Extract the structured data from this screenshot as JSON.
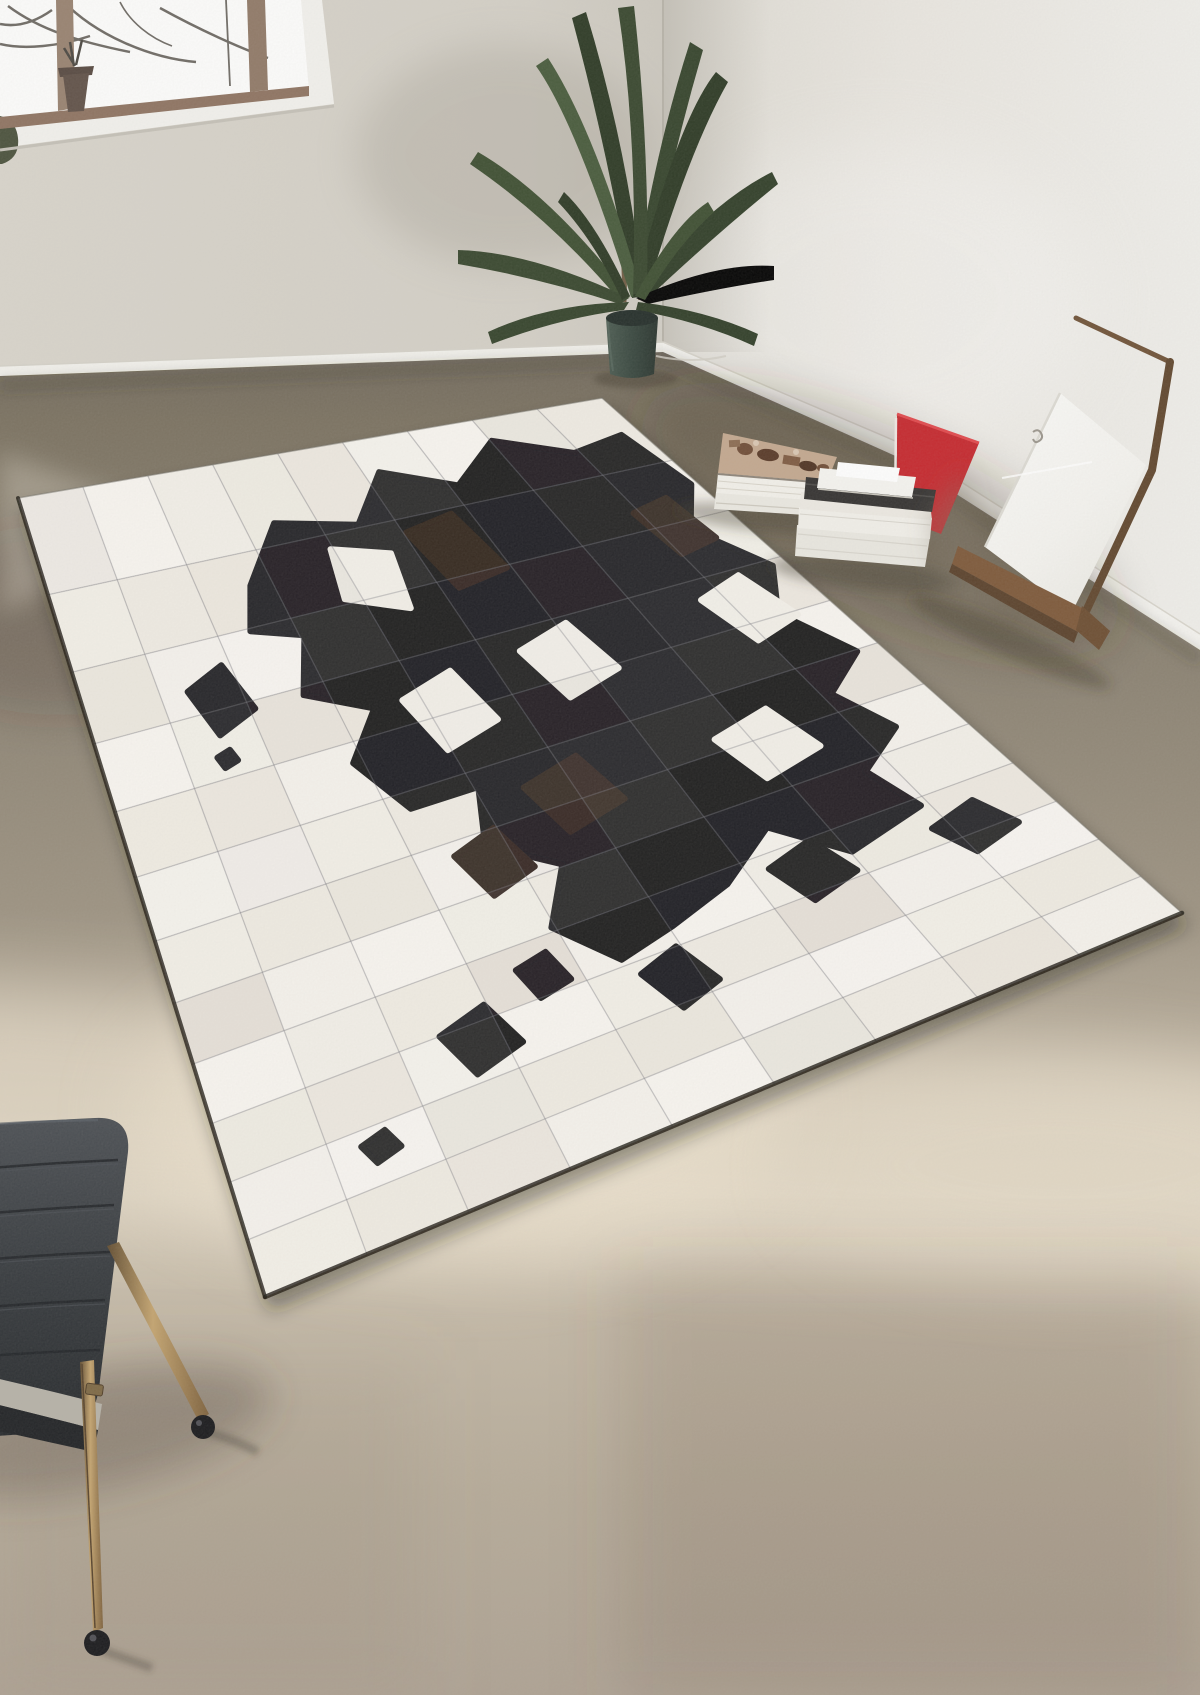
{
  "scene": {
    "kind": "interior-photo",
    "objects": [
      "window-with-branches",
      "palm-plant",
      "planter-pot",
      "wall-corner",
      "baseboard",
      "book-stack-left",
      "book-stack-right",
      "red-folder",
      "leaning-canvas",
      "wooden-easel",
      "patchwork-cowhide-rug",
      "side-chair",
      "sunlit-floor-patch"
    ]
  },
  "palette": {
    "wall_left": "#d6d2c9",
    "wall_right": "#e9e6e0",
    "baseboard": "#f3f2ee",
    "floor_dark": "#6e665a",
    "floor_mid": "#9b9180",
    "floor_sunlit": "#e0d6c4",
    "floor_bottom": "#ada192",
    "rug_white": "#f2efe8",
    "rug_black": "#17171a",
    "rug_brown": "#2e211b",
    "rug_seam": "#7d7d87",
    "plant_green": "#33422a",
    "pot_teal": "#3b4a42",
    "wood_brown": "#7c5738",
    "red_board": "#c5262c",
    "canvas_white": "#f7f6f3",
    "chair_back": "#34373b",
    "chair_brass": "#9a7b4f",
    "foot_black": "#1a1a1d"
  },
  "rug": {
    "cols": 9,
    "rows": 12,
    "perspective_pow": 0.85,
    "corners": {
      "w": [
        18,
        498
      ],
      "n": [
        602,
        398
      ],
      "e": [
        1182,
        913
      ],
      "s": [
        265,
        1297
      ]
    },
    "white_tiles": [
      "#f5f2ec",
      "#efebe2",
      "#f8f5f0",
      "#ece7de",
      "#f2efe7"
    ],
    "blobs": [
      {
        "name": "main-cow-patch",
        "fill": "black",
        "uv": [
          [
            0.3,
            0.12
          ],
          [
            0.38,
            0.06
          ],
          [
            0.5,
            0.08
          ],
          [
            0.58,
            0.03
          ],
          [
            0.68,
            0.06
          ],
          [
            0.78,
            0.02
          ],
          [
            0.88,
            0.05
          ],
          [
            0.97,
            0.04
          ],
          [
            0.99,
            0.12
          ],
          [
            0.93,
            0.18
          ],
          [
            0.98,
            0.26
          ],
          [
            0.93,
            0.33
          ],
          [
            0.97,
            0.42
          ],
          [
            0.9,
            0.47
          ],
          [
            0.93,
            0.55
          ],
          [
            0.86,
            0.6
          ],
          [
            0.88,
            0.68
          ],
          [
            0.78,
            0.71
          ],
          [
            0.72,
            0.63
          ],
          [
            0.64,
            0.69
          ],
          [
            0.56,
            0.72
          ],
          [
            0.49,
            0.74
          ],
          [
            0.44,
            0.66
          ],
          [
            0.49,
            0.58
          ],
          [
            0.42,
            0.52
          ],
          [
            0.45,
            0.44
          ],
          [
            0.36,
            0.44
          ],
          [
            0.32,
            0.36
          ],
          [
            0.38,
            0.3
          ],
          [
            0.3,
            0.26
          ],
          [
            0.34,
            0.19
          ],
          [
            0.27,
            0.17
          ]
        ]
      },
      {
        "name": "brown-shade-1",
        "fill": "brown",
        "uv": [
          [
            0.56,
            0.1
          ],
          [
            0.64,
            0.09
          ],
          [
            0.66,
            0.17
          ],
          [
            0.58,
            0.18
          ]
        ]
      },
      {
        "name": "brown-shade-2",
        "fill": "brown",
        "uv": [
          [
            0.5,
            0.46
          ],
          [
            0.58,
            0.44
          ],
          [
            0.6,
            0.52
          ],
          [
            0.52,
            0.54
          ]
        ]
      },
      {
        "name": "brown-shade-3",
        "fill": "brown",
        "uv": [
          [
            0.88,
            0.14
          ],
          [
            0.94,
            0.13
          ],
          [
            0.95,
            0.2
          ],
          [
            0.89,
            0.21
          ]
        ]
      },
      {
        "name": "brown-shade-4",
        "fill": "brown",
        "uv": [
          [
            0.38,
            0.52
          ],
          [
            0.44,
            0.5
          ],
          [
            0.46,
            0.57
          ],
          [
            0.4,
            0.59
          ]
        ]
      },
      {
        "name": "white-gap-1",
        "fill": "white",
        "uv": [
          [
            0.44,
            0.1
          ],
          [
            0.52,
            0.12
          ],
          [
            0.5,
            0.19
          ],
          [
            0.42,
            0.16
          ]
        ]
      },
      {
        "name": "white-gap-2",
        "fill": "white",
        "uv": [
          [
            0.42,
            0.3
          ],
          [
            0.5,
            0.28
          ],
          [
            0.52,
            0.36
          ],
          [
            0.44,
            0.38
          ]
        ]
      },
      {
        "name": "white-gap-3",
        "fill": "white",
        "uv": [
          [
            0.6,
            0.28
          ],
          [
            0.68,
            0.26
          ],
          [
            0.7,
            0.34
          ],
          [
            0.62,
            0.36
          ]
        ]
      },
      {
        "name": "white-gap-4",
        "fill": "white",
        "uv": [
          [
            0.86,
            0.28
          ],
          [
            0.93,
            0.26
          ],
          [
            0.95,
            0.34
          ],
          [
            0.88,
            0.36
          ]
        ]
      },
      {
        "name": "white-gap-5",
        "fill": "white",
        "uv": [
          [
            0.74,
            0.48
          ],
          [
            0.82,
            0.46
          ],
          [
            0.84,
            0.54
          ],
          [
            0.76,
            0.56
          ]
        ]
      },
      {
        "name": "spot-left",
        "fill": "black",
        "uv": [
          [
            0.15,
            0.22
          ],
          [
            0.21,
            0.2
          ],
          [
            0.23,
            0.26
          ],
          [
            0.17,
            0.28
          ]
        ]
      },
      {
        "name": "spot-left-speck",
        "fill": "black",
        "uv": [
          [
            0.155,
            0.305
          ],
          [
            0.175,
            0.3
          ],
          [
            0.18,
            0.315
          ],
          [
            0.16,
            0.32
          ]
        ]
      },
      {
        "name": "spot-right-1",
        "fill": "black",
        "uv": [
          [
            0.87,
            0.72
          ],
          [
            0.93,
            0.7
          ],
          [
            0.95,
            0.76
          ],
          [
            0.89,
            0.78
          ]
        ]
      },
      {
        "name": "spot-right-2",
        "fill": "black",
        "uv": [
          [
            0.69,
            0.69
          ],
          [
            0.75,
            0.67
          ],
          [
            0.77,
            0.74
          ],
          [
            0.71,
            0.76
          ]
        ]
      },
      {
        "name": "spot-bottom-1",
        "fill": "black",
        "uv": [
          [
            0.27,
            0.75
          ],
          [
            0.33,
            0.73
          ],
          [
            0.35,
            0.8
          ],
          [
            0.29,
            0.82
          ]
        ]
      },
      {
        "name": "spot-bottom-2",
        "fill": "black",
        "uv": [
          [
            0.38,
            0.7
          ],
          [
            0.42,
            0.69
          ],
          [
            0.43,
            0.74
          ],
          [
            0.39,
            0.75
          ]
        ]
      },
      {
        "name": "spot-bottom-3",
        "fill": "black",
        "uv": [
          [
            0.5,
            0.77
          ],
          [
            0.55,
            0.75
          ],
          [
            0.57,
            0.82
          ],
          [
            0.52,
            0.84
          ]
        ]
      },
      {
        "name": "spot-tiny",
        "fill": "black",
        "uv": [
          [
            0.145,
            0.855
          ],
          [
            0.175,
            0.845
          ],
          [
            0.185,
            0.875
          ],
          [
            0.155,
            0.885
          ]
        ]
      }
    ]
  }
}
